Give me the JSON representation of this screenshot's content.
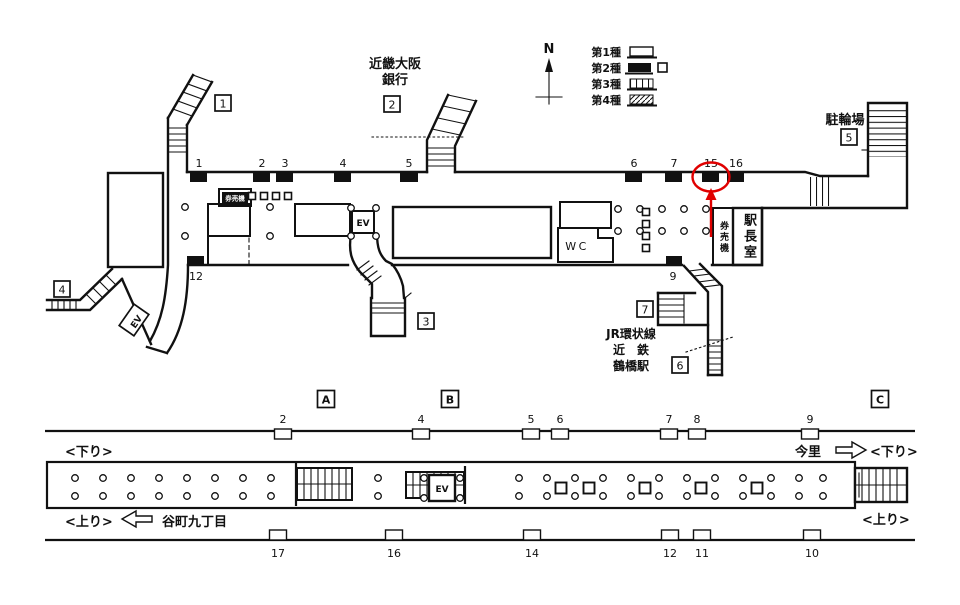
{
  "colors": {
    "line": "#111111",
    "accent": "#e00000",
    "bg": "#ffffff"
  },
  "compass": {
    "north": "N"
  },
  "legend": {
    "type1": "第1種",
    "type2": "第2種",
    "type3": "第3種",
    "type4": "第4種"
  },
  "concourse": {
    "exits": {
      "e1": "1",
      "e2": "2",
      "e3": "3",
      "e4": "4",
      "e5": "5",
      "e6": "6",
      "e7": "7"
    },
    "labels": {
      "bank1": "近畿大阪",
      "bank2": "銀行",
      "bicycle": "駐輪場",
      "stationmaster": "駅長室",
      "ticket_room": "券売機",
      "ticket_box": "券売機",
      "wc": "WC",
      "ev": "EV",
      "ev2": "EV",
      "jr": "JR環状線",
      "kintetsu": "近　鉄",
      "tsuruhashi": "鶴橋駅"
    },
    "positions": {
      "n1": "1",
      "n2": "2",
      "n3": "3",
      "n4": "4",
      "n5": "5",
      "n6": "6",
      "n7": "7",
      "n15": "15",
      "n16": "16",
      "n12": "12",
      "n9": "9"
    },
    "highlight": {
      "number": "15"
    }
  },
  "platform": {
    "sections": {
      "a": "A",
      "b": "B",
      "c": "C"
    },
    "labels": {
      "down_l": "<下り>",
      "down_r": "<下り>",
      "up_l": "<上り>",
      "up_r": "<上り>",
      "imazato": "今里",
      "tanimachi": "谷町九丁目",
      "ev": "EV"
    },
    "top": {
      "p2": "2",
      "p4": "4",
      "p5": "5",
      "p6": "6",
      "p7": "7",
      "p8": "8",
      "p9": "9"
    },
    "bottom": {
      "p17": "17",
      "p16": "16",
      "p14": "14",
      "p12": "12",
      "p11": "11",
      "p10": "10"
    }
  }
}
